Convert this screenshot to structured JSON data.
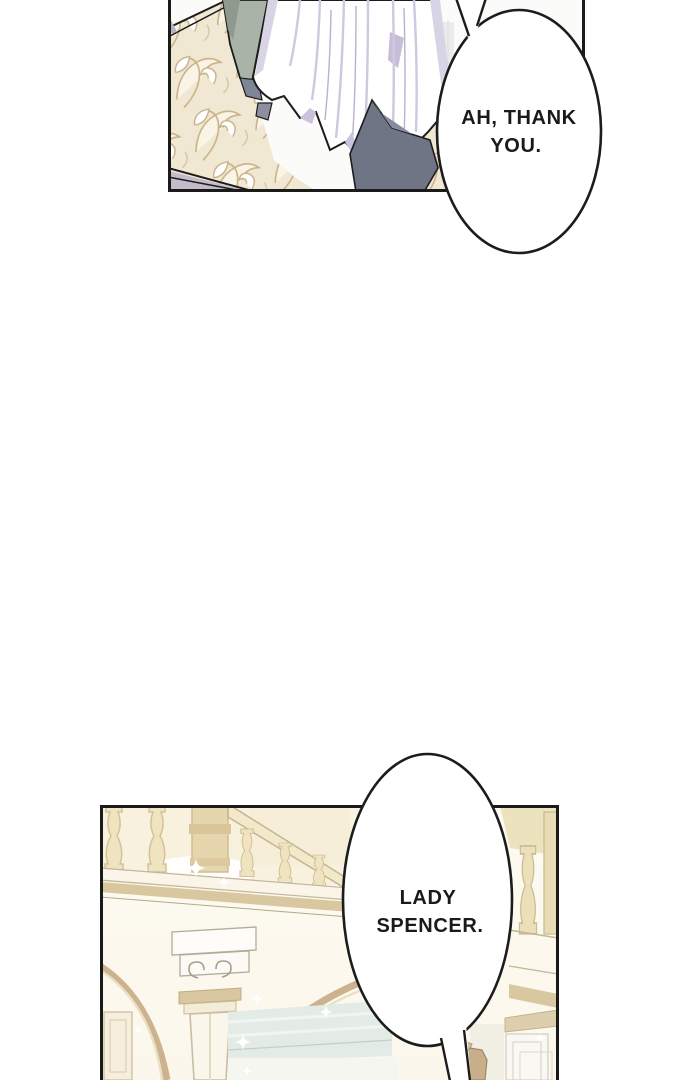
{
  "page": {
    "kind": "comic-strip-segment",
    "background": "#ffffff"
  },
  "panels": [
    {
      "id": "panel-top",
      "content": "figure in white gown beside ornate gilded chair"
    },
    {
      "id": "panel-bottom",
      "content": "palace interior with staircase balustrade, arches and column"
    }
  ],
  "bubbles": [
    {
      "id": "bubble-top",
      "tail_direction": "up",
      "lines": [
        "AH, THANK",
        "YOU."
      ]
    },
    {
      "id": "bubble-bottom",
      "tail_direction": "down",
      "lines": [
        "LADY",
        "SPENCER."
      ]
    }
  ],
  "colors": {
    "page_bg": "#ffffff",
    "panel_border": "#1a1a1a",
    "bubble_fill": "#ffffff",
    "bubble_stroke": "#1c1c1c",
    "text": "#1a1a1a",
    "filigree_bg": "#f1e8d3",
    "filigree_line": "#c9b186",
    "sage_garment": "#a9b3a8",
    "dress_shadow": "#d6d0e4",
    "slate_fabric": "#6f7585",
    "lavender_wedge": "#c4bbca",
    "baluster_cream": "#efe3c0",
    "arch_tan": "#cdb28f",
    "molding_tan": "#d9c7a0",
    "blue_gray_bands": "#e3ebe7",
    "corner_yellow": "#ebe3bd"
  }
}
